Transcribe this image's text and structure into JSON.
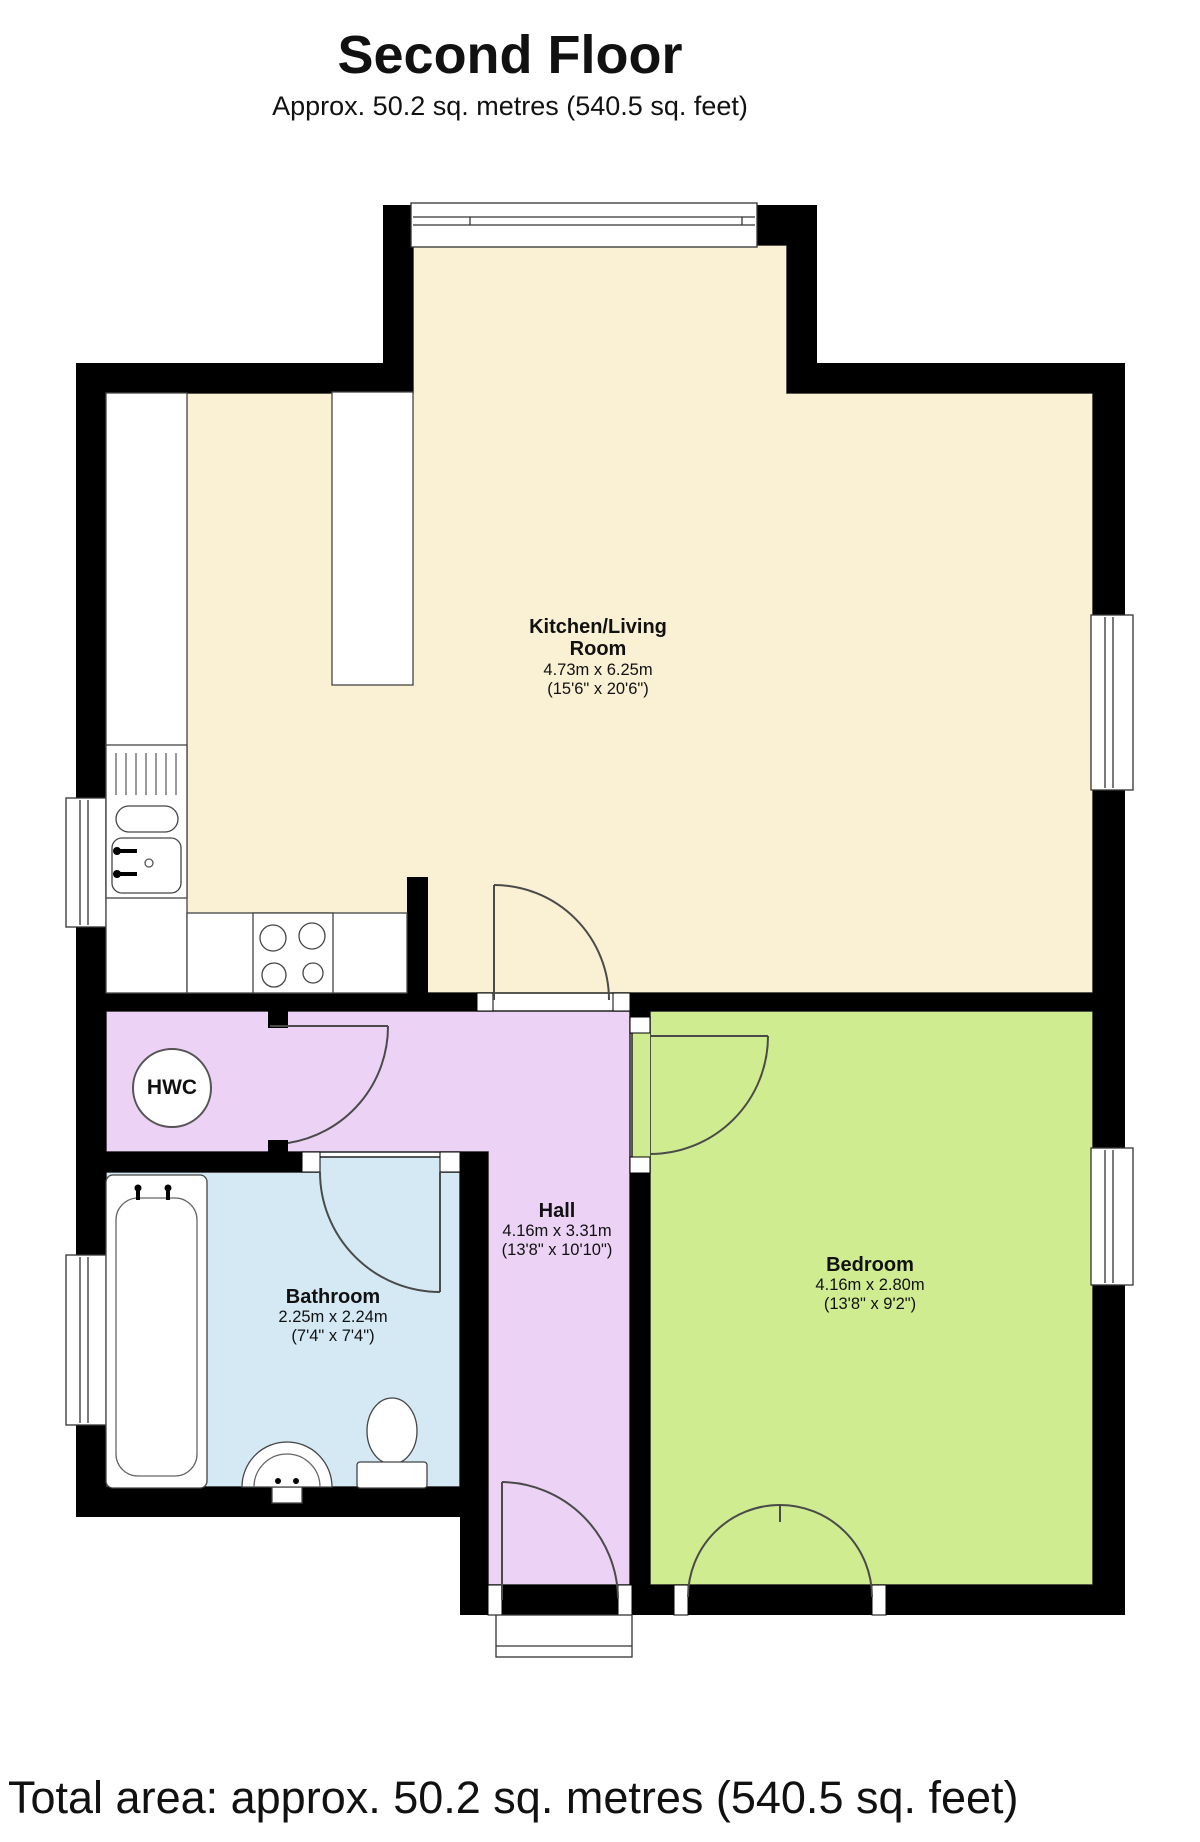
{
  "header": {
    "title": "Second Floor",
    "subtitle": "Approx. 50.2 sq. metres (540.5 sq. feet)"
  },
  "footer": {
    "total_area": "Total area: approx. 50.2 sq. metres (540.5 sq. feet)"
  },
  "rooms": [
    {
      "id": "kitchen-living",
      "name": "Kitchen/Living Room",
      "metric": "4.73m x 6.25m",
      "imperial": "(15'6\" x 20'6\")",
      "floor_color": "#FAF0D3"
    },
    {
      "id": "hall",
      "name": "Hall",
      "metric": "4.16m x 3.31m",
      "imperial": "(13'8\" x 10'10\")",
      "floor_color": "#ECD3F6"
    },
    {
      "id": "bathroom",
      "name": "Bathroom",
      "metric": "2.25m x 2.24m",
      "imperial": "(7'4\" x 7'4\")",
      "floor_color": "#D5E9F5"
    },
    {
      "id": "bedroom",
      "name": "Bedroom",
      "metric": "4.16m x 2.80m",
      "imperial": "(13'8\" x 9'2\")",
      "floor_color": "#CFEC90"
    }
  ],
  "cupboard": {
    "label": "HWC"
  },
  "colors": {
    "wall": "#000000",
    "door_swing": "#4a4a4a",
    "fixture_outline": "#444444",
    "window_outline": "#333333"
  }
}
